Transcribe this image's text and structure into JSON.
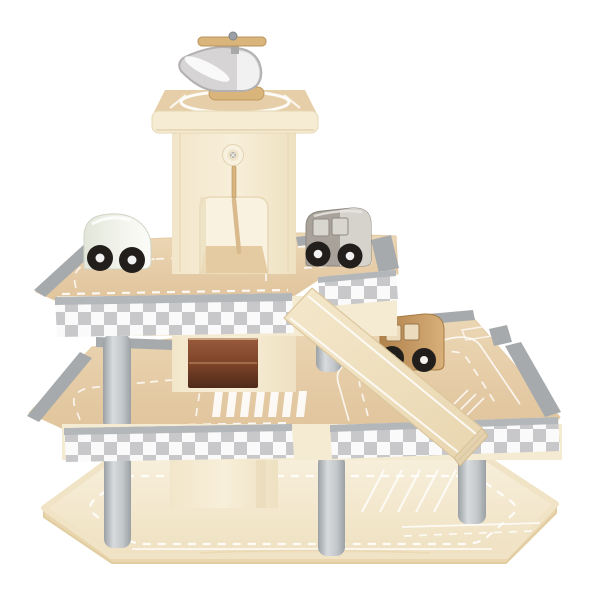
{
  "scene": {
    "type": "toy-product-photo",
    "description": "Wooden toy parking garage with three levels on a white background: a central elevator tower topped by a helipad with a grey toy helicopter, checkered-edge parking decks on grey pillars, a wooden ramp between levels, and three toy cars (white, grey and natural wood).",
    "background_color": "#ffffff",
    "objects": {
      "helicopter": {
        "body_color_name": "grey",
        "rotor_material": "natural wood",
        "location": "rooftop helipad"
      },
      "elevator_tower": {
        "features": [
          "helipad roof board",
          "round screw button",
          "arched elevator opening with wooden lift rod",
          "dark storage opening at middle level"
        ]
      },
      "decks": {
        "count": 3,
        "edge_style": "grey-and-white checkered band",
        "surface": "natural wood with white road markings",
        "markings": [
          "dashed lanes",
          "zebra crosswalk",
          "parking bays",
          "hatched island"
        ]
      },
      "ramp": {
        "material": "natural wood",
        "markings": "white edge lines",
        "connects": "upper deck to middle deck"
      },
      "pillars": {
        "visible_count": 5,
        "shape": "cylinder",
        "color_name": "light grey"
      },
      "cars": [
        {
          "type": "van",
          "color_name": "white",
          "location": "upper deck left"
        },
        {
          "type": "van",
          "color_name": "grey",
          "location": "upper deck right of tower"
        },
        {
          "type": "van",
          "color_name": "natural wood",
          "location": "middle deck beside ramp"
        }
      ],
      "bumper_rails": {
        "visible_count": 8,
        "color_name": "grey"
      }
    }
  },
  "palette": {
    "bg": "#ffffff",
    "wood_cream": "#f5ebd2",
    "wood_cream_dark": "#e9d9b6",
    "wood_tan": "#e7d0ab",
    "wood_tan_dark": "#dfc298",
    "wood_base": "#f6eed9",
    "wood_base_dark": "#eadbb6",
    "wood_accent": "#d9b57c",
    "wood_accent_dark": "#bb9257",
    "rail_gray": "#a6aaad",
    "rail_gray_light": "#c7cacc",
    "pillar_gray": "#c6c9cc",
    "pillar_gray_dark": "#9aa0a4",
    "checker_gray": "#c8c8ca",
    "checker_white": "#fafafa",
    "fascia_cap": "#b4b7ba",
    "road_white": "#ffffff",
    "heli_gray": "#d6d4d4",
    "heli_outline": "#b3b0b0",
    "car_white": "#eef1e8",
    "car_gray": "#a8a29a",
    "car_gray_front": "#d6d3cd",
    "car_tan": "#c69a63",
    "car_tan_window": "#ecdcbd",
    "wheel_black": "#221e1c",
    "wheel_hub": "#f2f2f2",
    "opening_brown": "#8a5138",
    "opening_brown_dark": "#4e2a1a"
  }
}
